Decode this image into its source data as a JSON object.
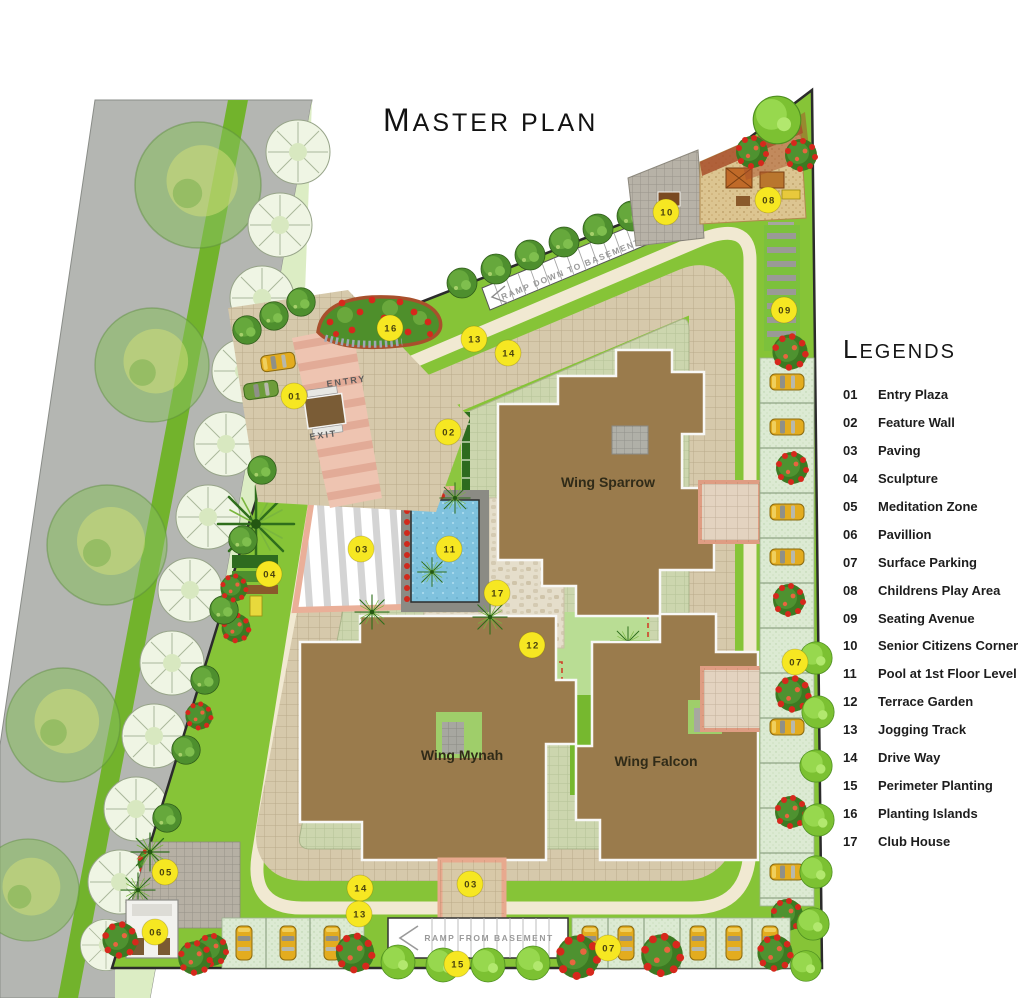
{
  "title": {
    "lead": "M",
    "rest": "ASTER PLAN"
  },
  "legend": {
    "heading_lead": "L",
    "heading_rest": "EGENDS",
    "items": [
      {
        "num": "01",
        "label": "Entry Plaza"
      },
      {
        "num": "02",
        "label": "Feature Wall"
      },
      {
        "num": "03",
        "label": "Paving"
      },
      {
        "num": "04",
        "label": "Sculpture"
      },
      {
        "num": "05",
        "label": "Meditation Zone"
      },
      {
        "num": "06",
        "label": "Pavillion"
      },
      {
        "num": "07",
        "label": "Surface Parking"
      },
      {
        "num": "08",
        "label": "Childrens Play Area"
      },
      {
        "num": "09",
        "label": "Seating Avenue"
      },
      {
        "num": "10",
        "label": "Senior Citizens Corner"
      },
      {
        "num": "11",
        "label": "Pool at 1st Floor Level"
      },
      {
        "num": "12",
        "label": "Terrace Garden"
      },
      {
        "num": "13",
        "label": "Jogging Track"
      },
      {
        "num": "14",
        "label": "Drive Way"
      },
      {
        "num": "15",
        "label": "Perimeter Planting"
      },
      {
        "num": "16",
        "label": "Planting Islands"
      },
      {
        "num": "17",
        "label": "Club House"
      }
    ]
  },
  "plan": {
    "wings": [
      {
        "name": "Wing Sparrow"
      },
      {
        "name": "Wing Mynah"
      },
      {
        "name": "Wing Falcon"
      }
    ],
    "entry_label": "ENTRY",
    "exit_label": "EXIT",
    "ramp_top_label": "RAMP DOWN TO BASEMENT",
    "ramp_bottom_label": "RAMP FROM BASEMENT",
    "markers": [
      {
        "num": "16",
        "x": 390,
        "y": 328,
        "name": "planting-islands-marker"
      },
      {
        "num": "13",
        "x": 474,
        "y": 339,
        "name": "jogging-track-marker"
      },
      {
        "num": "14",
        "x": 508,
        "y": 353,
        "name": "drive-way-marker"
      },
      {
        "num": "01",
        "x": 294,
        "y": 396,
        "name": "entry-plaza-marker"
      },
      {
        "num": "02",
        "x": 448,
        "y": 432,
        "name": "feature-wall-marker"
      },
      {
        "num": "10",
        "x": 666,
        "y": 212,
        "name": "senior-citizens-corner-marker"
      },
      {
        "num": "08",
        "x": 768,
        "y": 200,
        "name": "childrens-play-area-marker"
      },
      {
        "num": "09",
        "x": 784,
        "y": 310,
        "name": "seating-avenue-marker"
      },
      {
        "num": "03",
        "x": 361,
        "y": 549,
        "name": "paving-marker"
      },
      {
        "num": "11",
        "x": 449,
        "y": 549,
        "name": "pool-marker"
      },
      {
        "num": "04",
        "x": 269,
        "y": 574,
        "name": "sculpture-marker"
      },
      {
        "num": "17",
        "x": 497,
        "y": 593,
        "name": "club-house-marker"
      },
      {
        "num": "12",
        "x": 532,
        "y": 645,
        "name": "terrace-garden-marker"
      },
      {
        "num": "07",
        "x": 795,
        "y": 662,
        "name": "surface-parking-marker"
      },
      {
        "num": "05",
        "x": 165,
        "y": 872,
        "name": "meditation-zone-marker"
      },
      {
        "num": "14",
        "x": 360,
        "y": 888,
        "name": "drive-way-marker-2"
      },
      {
        "num": "13",
        "x": 359,
        "y": 914,
        "name": "jogging-track-marker-2"
      },
      {
        "num": "03",
        "x": 470,
        "y": 884,
        "name": "paving-marker-2"
      },
      {
        "num": "06",
        "x": 155,
        "y": 932,
        "name": "pavillion-marker"
      },
      {
        "num": "15",
        "x": 457,
        "y": 964,
        "name": "perimeter-planting-marker"
      },
      {
        "num": "07",
        "x": 608,
        "y": 948,
        "name": "surface-parking-marker-2"
      }
    ]
  },
  "colors": {
    "marker": "#f6e722",
    "building": "#9a7b4c",
    "pool": "#7fc2de",
    "lawn": "#86c437",
    "driveway": "#d6c9ab",
    "track": "#f1e9d2",
    "road": "#b4b6b2",
    "entry_road": "#eec4b1",
    "plaza_border": "#eaaf98"
  }
}
